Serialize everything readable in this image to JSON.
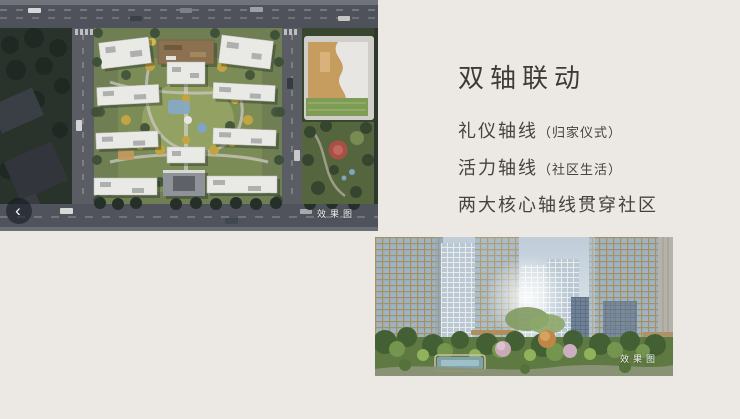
{
  "colors": {
    "page_background": "#ECE9E4",
    "text": "#46423E",
    "title_text": "#3E3A37",
    "watermark_text": "#FFFFFF",
    "carousel_button_bg": "rgba(16,22,30,0.55)"
  },
  "carousel": {
    "prev_icon": "‹"
  },
  "panel": {
    "title": "双轴联动",
    "lines": [
      {
        "main": "礼仪轴线",
        "note": "（归家仪式）"
      },
      {
        "main": "活力轴线",
        "note": "（社区生活）"
      },
      {
        "main": "两大核心轴线贯穿社区",
        "note": ""
      }
    ]
  },
  "aerial_image": {
    "watermark": "效果图"
  },
  "street_image": {
    "watermark": "效果图"
  }
}
